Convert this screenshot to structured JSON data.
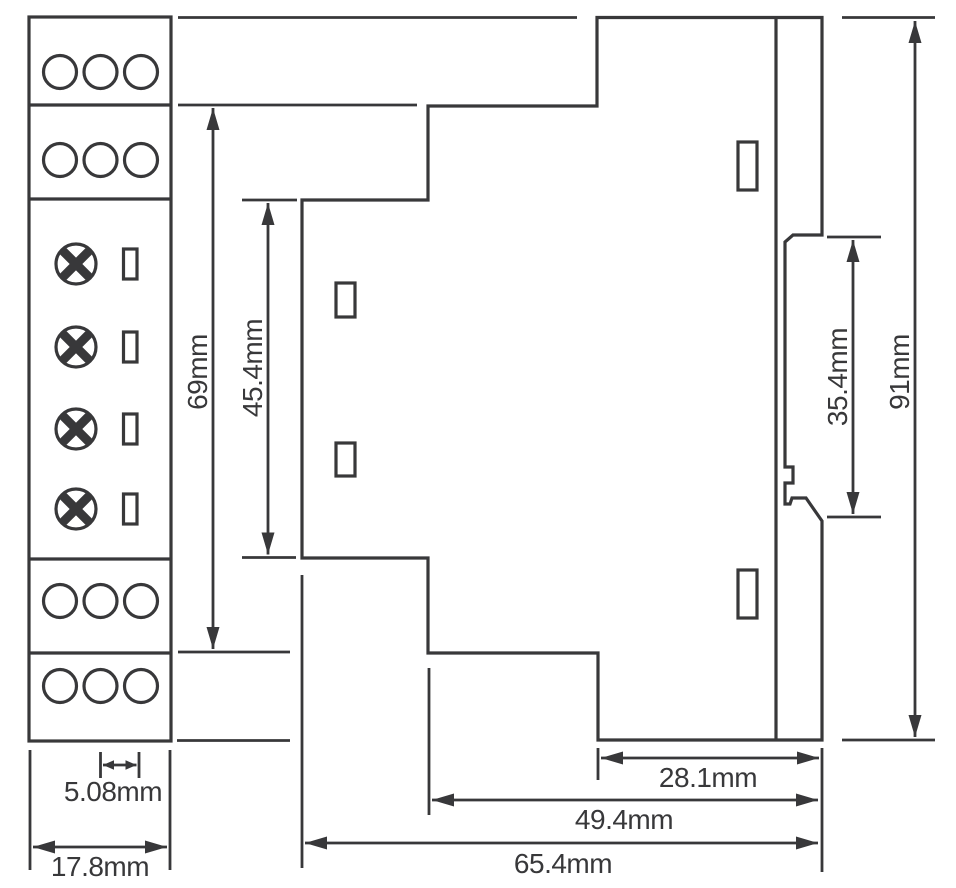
{
  "colors": {
    "ink": "#38383a",
    "background": "#ffffff"
  },
  "drawing": {
    "type": "technical-dimension-drawing",
    "subject": "DIN-rail module outline drawing, front view and side profile view",
    "units": "mm",
    "views": {
      "front": {
        "description": "front view with four 3-hole terminal blocks, four adjustment screws and four indicator windows",
        "terminal_blocks": 4,
        "holes_per_block": 3,
        "adjustment_screws": 4,
        "indicator_windows": 4
      },
      "side": {
        "description": "side profile with stepped housing, DIN-rail recess, latch clip and four clip slots",
        "clip_slots": 4
      }
    },
    "dimensions": {
      "terminal_pitch": "5.08mm",
      "module_width": "17.8mm",
      "step_section_height": "69mm",
      "front_section_height": "45.4mm",
      "din_recess_height": "35.4mm",
      "overall_height": "91mm",
      "rear_depth": "28.1mm",
      "body_depth": "49.4mm",
      "overall_depth": "65.4mm"
    }
  }
}
